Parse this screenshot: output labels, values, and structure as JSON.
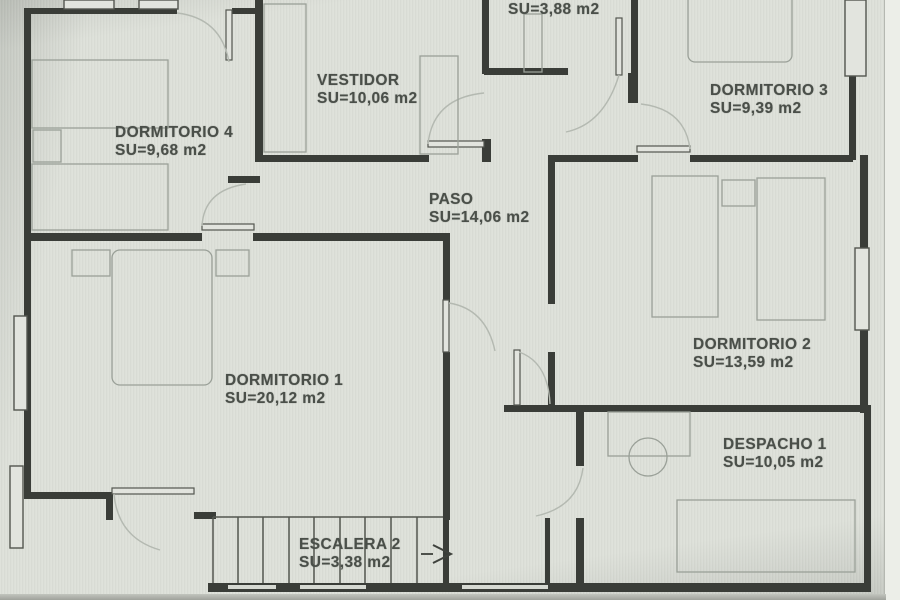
{
  "plan": {
    "rooms": [
      {
        "id": "bano2",
        "name": "BAÑO 2",
        "area": "SU=3,88 m2"
      },
      {
        "id": "vestidor",
        "name": "VESTIDOR",
        "area": "SU=10,06 m2"
      },
      {
        "id": "dormitorio3",
        "name": "DORMITORIO 3",
        "area": "SU=9,39 m2"
      },
      {
        "id": "dormitorio4",
        "name": "DORMITORIO 4",
        "area": "SU=9,68 m2"
      },
      {
        "id": "paso",
        "name": "PASO",
        "area": "SU=14,06 m2"
      },
      {
        "id": "dormitorio2",
        "name": "DORMITORIO 2",
        "area": "SU=13,59 m2"
      },
      {
        "id": "dormitorio1",
        "name": "DORMITORIO 1",
        "area": "SU=20,12 m2"
      },
      {
        "id": "despacho1",
        "name": "DESPACHO 1",
        "area": "SU=10,05 m2"
      },
      {
        "id": "escalera2",
        "name": "ESCALERA 2",
        "area": "SU=3,38 m2"
      }
    ],
    "colors": {
      "paper": "#dde0d9",
      "wall": "#3a3d38",
      "line": "#53564f",
      "furniture": "#9aa098",
      "arc": "#b4b9b1",
      "text": "#4a4f49",
      "leaf_fill": "#e2e4de"
    }
  }
}
